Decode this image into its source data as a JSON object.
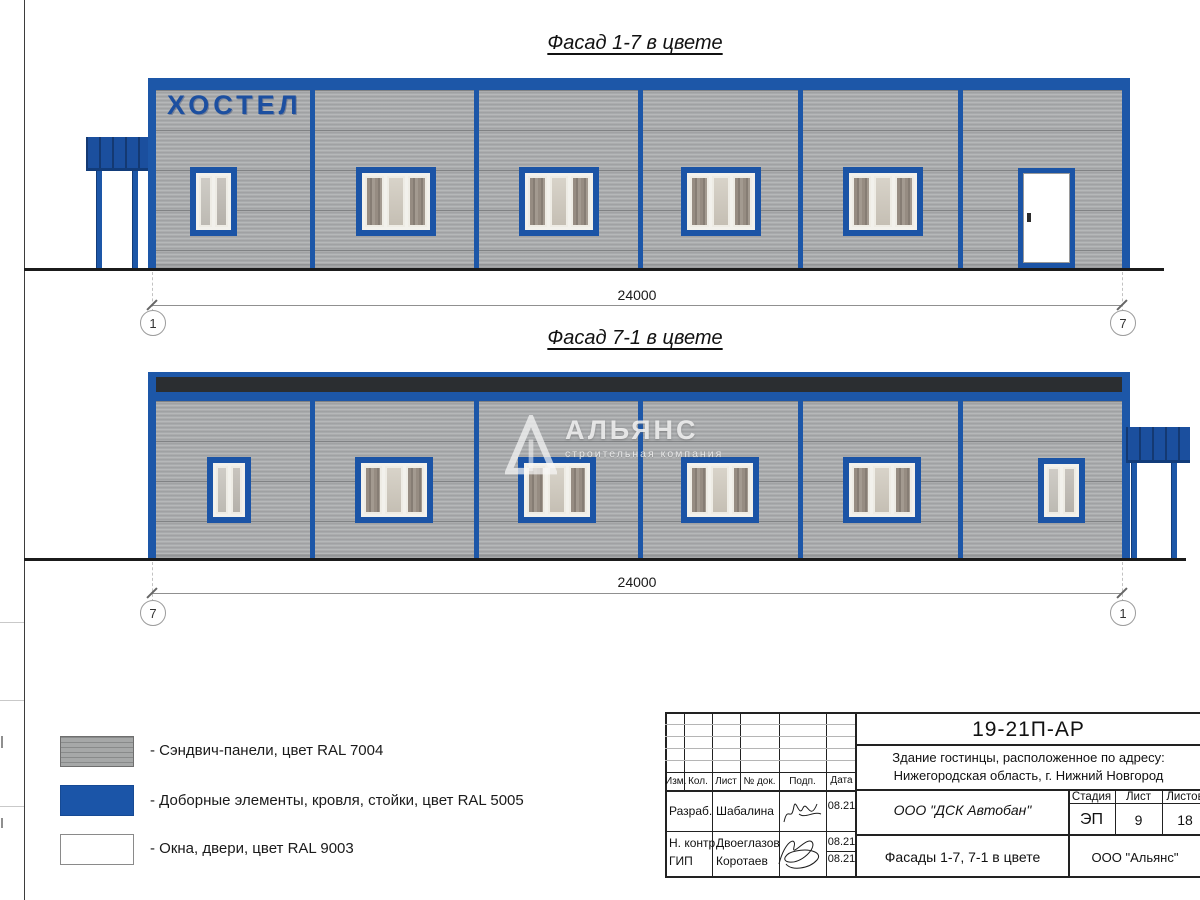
{
  "page": {
    "facade1": {
      "title": "Фасад 1-7 в цвете",
      "sign": "ХОСТЕЛ",
      "dim_label": "24000",
      "axis_left": "1",
      "axis_right": "7"
    },
    "facade2": {
      "title": "Фасад 7-1 в цвете",
      "dim_label": "24000",
      "axis_left": "7",
      "axis_right": "1"
    },
    "watermark": {
      "brand": "АЛЬЯНС",
      "tagline": "строительная компания"
    },
    "legend": {
      "items": [
        {
          "label": "- Сэндвич-панели, цвет RAL 7004"
        },
        {
          "label": "- Доборные элементы, кровля, стойки, цвет RAL 5005"
        },
        {
          "label": "- Окна, двери, цвет RAL 9003"
        }
      ]
    },
    "colors": {
      "accent_blue": "#1d57a8",
      "panel_gray": "#a8aaac",
      "dark_band": "#2b2e31",
      "window_white": "#ffffff"
    },
    "titleblock": {
      "doc_code": "19-21П-АР",
      "address_line1": "Здание гостинцы, расположенное по адресу:",
      "address_line2": "Нижегородская область, г. Нижний Новгород",
      "col_izm": "Изм.",
      "col_kol": "Кол.",
      "col_list": "Лист",
      "col_ndok": "№ док.",
      "col_podp": "Подп.",
      "col_data": "Дата",
      "row1_role": "Разраб.",
      "row1_name": "Шабалина",
      "row1_date": "08.21",
      "row2_role": "Н. контр.",
      "row2_name": "Двоеглазов",
      "row2_date": "08.21",
      "row3_role": "ГИП",
      "row3_name": "Коротаев",
      "row3_date": "08.21",
      "contractor": "ООО \"ДСК Автобан\"",
      "stage_label": "Стадия",
      "list_label": "Лист",
      "listov_label": "Листов",
      "stage_value": "ЭП",
      "list_value": "9",
      "listov_value": "18",
      "doc_title": "Фасады 1-7, 7-1 в цвете",
      "org": "ООО \"Альянс\""
    }
  }
}
